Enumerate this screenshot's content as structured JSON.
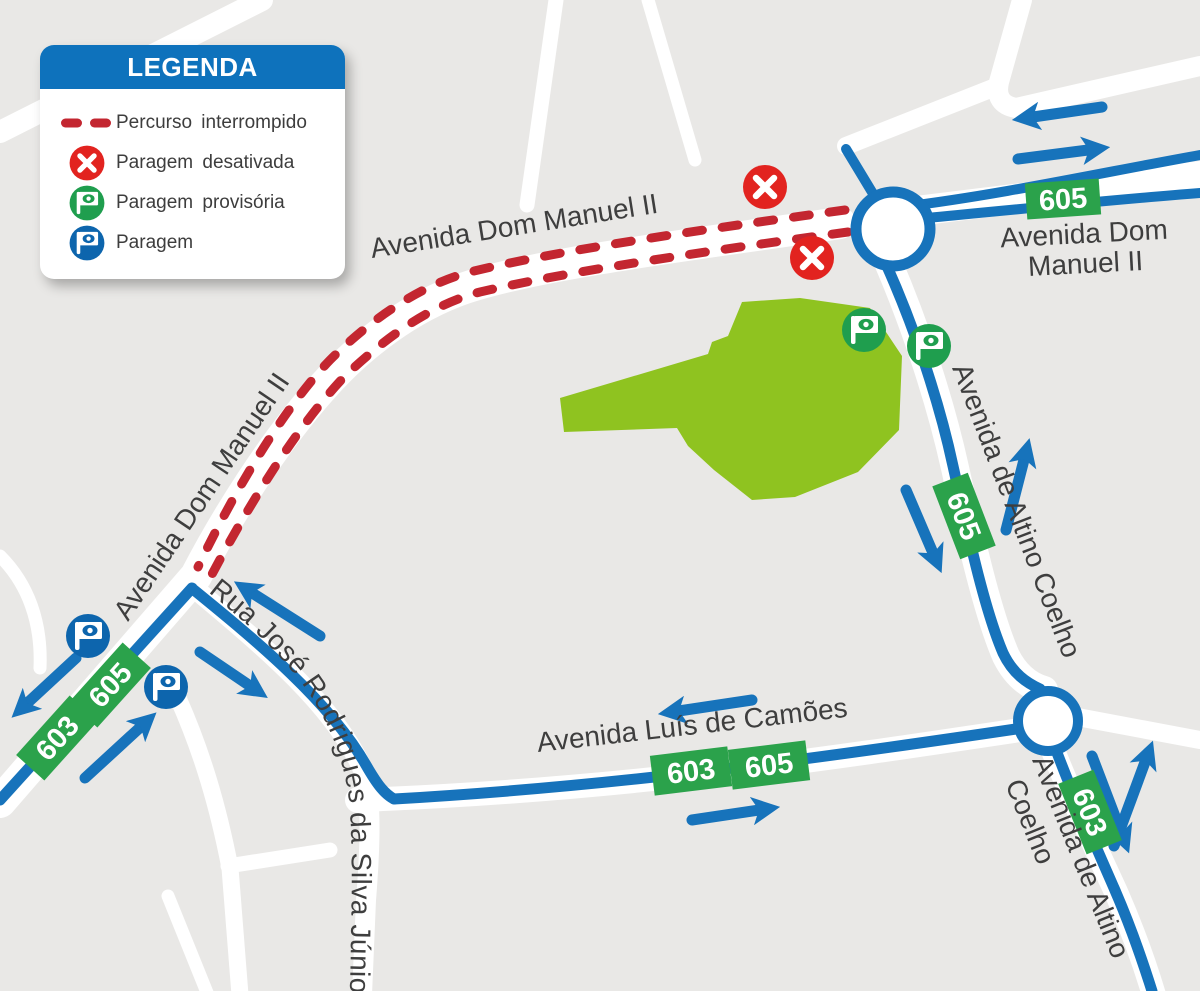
{
  "legend": {
    "title": "LEGENDA",
    "items": [
      {
        "label": "Percurso interrompido",
        "icon": "red-dashed-line",
        "color": "#c32630"
      },
      {
        "label": "Paragem desativada",
        "icon": "disabled-stop",
        "color": "#e2231f"
      },
      {
        "label": "Paragem provisória",
        "icon": "temporary-stop",
        "color": "#1f9e4e"
      },
      {
        "label": "Paragem",
        "icon": "regular-stop",
        "color": "#0d65ad"
      }
    ]
  },
  "map": {
    "labels": {
      "dom_manuel_top": "Avenida Dom Manuel II",
      "dom_manuel_right_line1": "Avenida Dom",
      "dom_manuel_right_line2": "Manuel II",
      "dom_manuel_left": "Avenida Dom Manuel II",
      "altino_right": "Avenida de Altino Coelho",
      "altino_bottom_line1": "Avenida de Altino",
      "altino_bottom_line2": "Coelho",
      "camoes": "Avenida Luís de Camões",
      "rua_jose": "Rua José Rodrigues da Silva Júnior"
    },
    "badges": {
      "tr_605": "605",
      "altino_n_605": "605",
      "west_605": "605",
      "west_603": "603",
      "camoes_603": "603",
      "camoes_605": "605",
      "altino_s_603": "603"
    },
    "stops": {
      "disabled_count": 2,
      "temporary_count": 2,
      "regular_count": 2
    },
    "colors": {
      "background": "#e9e8e6",
      "street_white": "#ffffff",
      "route_blue": "#1773bb",
      "interrupted_red": "#c32630",
      "disabled_stop_red": "#e2231f",
      "temporary_stop_green": "#1f9e4e",
      "regular_stop_blue": "#0d65ad",
      "badge_green": "#2ba24b",
      "park_green": "#8fc320",
      "label_text": "#3e3e3e",
      "legend_header_blue": "#0e72bc"
    }
  }
}
